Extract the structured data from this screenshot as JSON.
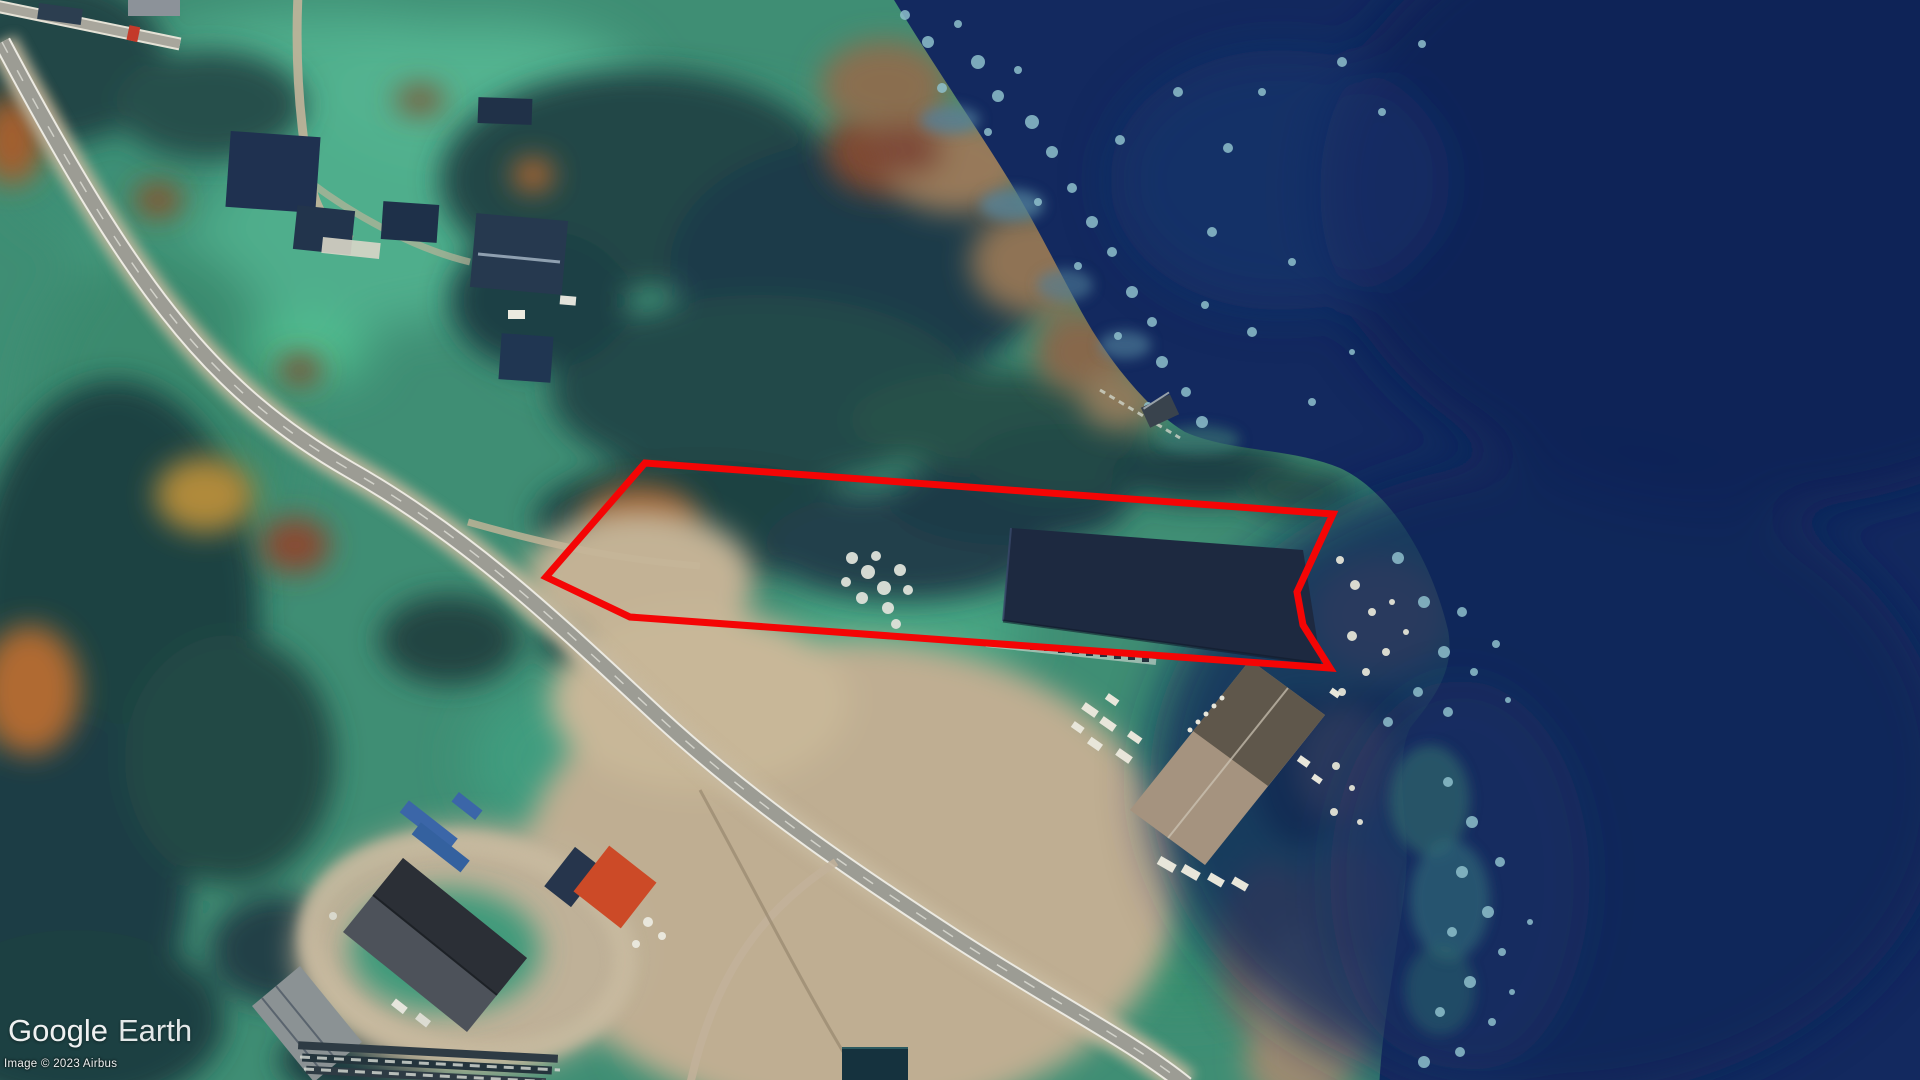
{
  "app": {
    "name": "Google Earth"
  },
  "watermark": {
    "google": "Google",
    "earth": "Earth"
  },
  "attribution": {
    "text": "Image © 2023 Airbus"
  },
  "map": {
    "colors": {
      "water_deep": "#13295f",
      "water_shallow_rocks": "#8fc0cc",
      "field_green": "#4fae8c",
      "forest_dark": "#1e4243",
      "marsh_brown": "#97795a",
      "dirt_tan": "#bfae92",
      "road_asphalt": "#9c9c94",
      "road_edge_line": "#eceae2",
      "parcel_red": "#f40505"
    },
    "parcel_outline": {
      "color": "#f40505",
      "stroke_width": 7,
      "points": "645,463 1333,514 1297,592 1303,625 1330,668 630,617 546,577"
    }
  }
}
